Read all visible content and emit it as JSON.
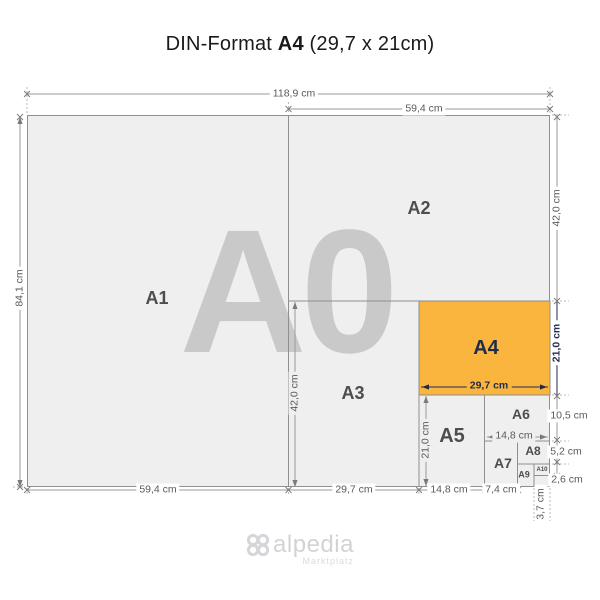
{
  "title": {
    "prefix": "DIN-Format",
    "format": "A4",
    "size": "(29,7 x 21cm)"
  },
  "watermark": "A0",
  "labels": {
    "a1": "A1",
    "a2": "A2",
    "a3": "A3",
    "a4": "A4",
    "a5": "A5",
    "a6": "A6",
    "a7": "A7",
    "a8": "A8",
    "a9": "A9",
    "a10": "A10"
  },
  "dims": {
    "top_full": "118,9 cm",
    "top_right": "59,4 cm",
    "left": "84,1 cm",
    "right_a2": "42,0 cm",
    "right_a4": "21,0 cm",
    "right_a6": "10,5 cm",
    "right_a8": "5,2 cm",
    "right_a10": "2,6 cm",
    "bottom_a1": "59,4 cm",
    "bottom_a3": "29,7 cm",
    "bottom_a5": "14,8 cm",
    "bottom_a7": "7,4 cm",
    "bottom_a10": "3,7 cm",
    "inner_a3_height": "42,0 cm",
    "inner_a5_height": "21,0 cm",
    "inner_a4_width": "29,7 cm",
    "inner_a6_width": "14,8 cm"
  },
  "colors": {
    "highlight_orange": "#f9b53e",
    "paper_gray": "#efefef",
    "line_gray": "#8f8f8f",
    "accent_navy": "#1e2b4d",
    "watermark_gray": "#c9c9c9",
    "logo_gray": "#d3d3d7"
  },
  "logo": {
    "name": "alpedia",
    "tagline": "Marktplatz"
  }
}
